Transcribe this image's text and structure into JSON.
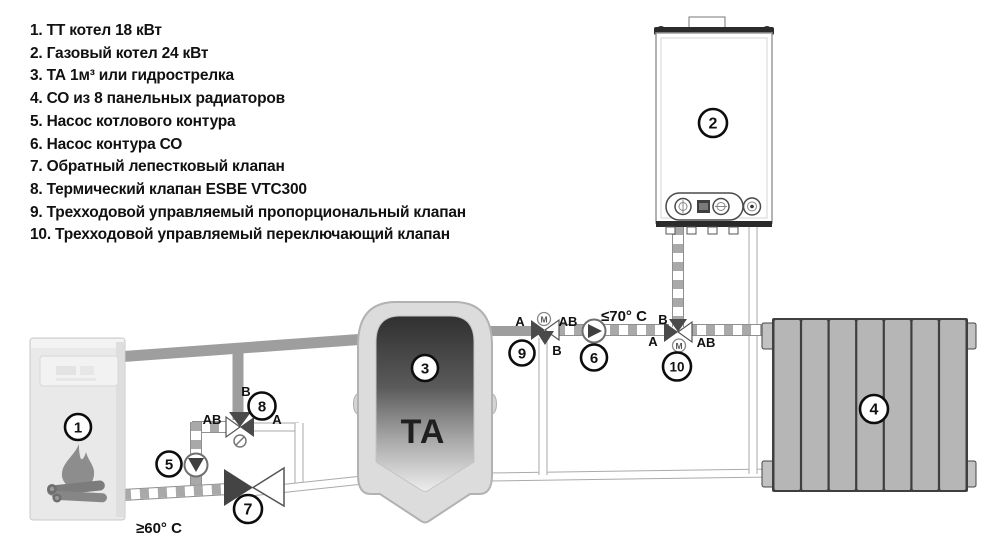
{
  "legend": {
    "items": [
      "1. ТТ котел 18 кВт",
      "2. Газовый котел 24 кВт",
      "3. ТА 1м³ или гидрострелка",
      "4. СО из 8 панельных радиаторов",
      "5. Насос котлового контура",
      "6. Насос контура СО",
      "7. Обратный лепестковый клапан",
      "8. Термический клапан ESBE VTC300",
      "9. Трехходовой управляемый пропорциональный клапан",
      "10. Трехходовой управляемый переключающий клапан"
    ]
  },
  "badges": [
    "1",
    "2",
    "3",
    "4",
    "5",
    "6",
    "7",
    "8",
    "9",
    "10"
  ],
  "tank": {
    "label": "TA"
  },
  "valve8": {
    "b": "B",
    "ab": "AB",
    "a": "A"
  },
  "valve9": {
    "a": "A",
    "ab": "AB",
    "b": "B",
    "motor": "M"
  },
  "valve10": {
    "b": "B",
    "a": "A",
    "ab": "AB",
    "motor": "M"
  },
  "temps": {
    "co_supply": "≤70° C",
    "tt_return": "≥60° C"
  },
  "watermark": "AVVI",
  "colors": {
    "pipe_gray": "#9e9e9e",
    "checker_gray": "#a9a9a9",
    "pipe_border": "#8f8f8f",
    "valve_dark": "#4a4a4a",
    "radiator": "#b6b6b6",
    "tank_shell": "#dcdcdc",
    "boiler_body": "#e9e9e9",
    "text": "#111111"
  }
}
